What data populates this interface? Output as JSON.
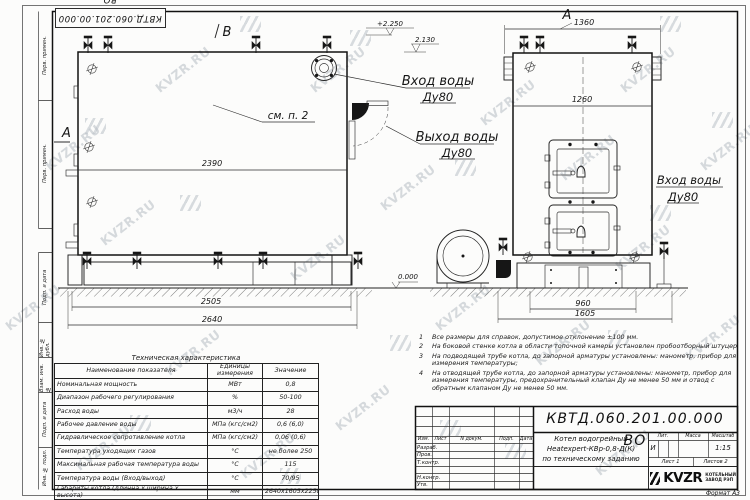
{
  "sheet": {
    "top_stamp": "КВТД.060.201.00.000 ВО",
    "watermark": "KVZR.RU"
  },
  "margin": {
    "labels": [
      "Перв. примен.",
      "Перв. примен.",
      "Подп. и дата",
      "Инв. № дубл.",
      "Взам. инв. №",
      "Подп. и дата",
      "Инв. № подл."
    ]
  },
  "drawing": {
    "markers": {
      "b": "B",
      "a_side": "A",
      "a_view": "A"
    },
    "see_note": "см. п. 2",
    "elevations": {
      "top": "+2.250",
      "mid": "2.130",
      "zero": "0.000"
    },
    "dims": {
      "side_inner": "2390",
      "side_skid": "2505",
      "side_total": "2640",
      "front_top": "1360",
      "front_body": "1260",
      "front_base": "960",
      "front_total": "1605"
    },
    "labels": {
      "inlet_top": {
        "title": "Вход воды",
        "dn": "Ду80"
      },
      "outlet": {
        "title": "Выход воды",
        "dn": "Ду80"
      },
      "inlet_side": {
        "title": "Вход воды",
        "dn": "Ду80"
      }
    }
  },
  "spec_table": {
    "title": "Техническая характеристика",
    "headers": [
      "Наименование показателя",
      "Единицы измерения",
      "Значение"
    ],
    "rows": [
      {
        "name": "Номинальная мощность",
        "unit": "МВт",
        "value": "0,8"
      },
      {
        "name": "Диапазон рабочего регулирования",
        "unit": "%",
        "value": "50-100"
      },
      {
        "name": "Расход воды",
        "unit": "м3/ч",
        "value": "28"
      },
      {
        "name": "Рабочее давление воды",
        "unit": "МПа (кгс/см2)",
        "value": "0,6 (6,0)"
      },
      {
        "name": "Гидравлическое сопротивление котла",
        "unit": "МПа (кгс/см2)",
        "value": "0,06 (0,6)"
      },
      {
        "name": "Температура уходящих газов",
        "unit": "°С",
        "value": "не более 250"
      },
      {
        "name": "Максимальная рабочая температура воды",
        "unit": "°С",
        "value": "115"
      },
      {
        "name": "Температура воды (Вход/выход)",
        "unit": "°С",
        "value": "70/95"
      },
      {
        "name": "Габариты котла (длинна х ширина х высота)",
        "unit": "мм",
        "value": "2640х1605х2250"
      }
    ]
  },
  "notes": {
    "items": [
      {
        "num": "1",
        "text": "Все размеры для справок, допустимое отклонение ±100 мм."
      },
      {
        "num": "2",
        "text": "На боковой стенке котла в области топочной камеры установлен пробоотборный штуцер"
      },
      {
        "num": "3",
        "text": "На подводящей трубе котла, до запорной арматуры установлены: манометр, прибор для измерения температуры;"
      },
      {
        "num": "4",
        "text": "На отводящей трубе котла, до запорной арматуры установлены: манометр, прибор для измерения температуры, предохранительный клапан Ду не менее 50 мм и отвод с обратным клапаном Ду не менее 50 мм."
      }
    ]
  },
  "title_block": {
    "doc_number": "КВТД.060.201.00.000 ВО",
    "columns": [
      "Изм.",
      "Лист",
      "N докум.",
      "Подп.",
      "Дата"
    ],
    "rows": [
      "Разраб.",
      "Пров.",
      "Т.контр.",
      "Н.контр.",
      "Утв."
    ],
    "name_line1": "Котел водогрейный",
    "name_line2": "Heatexpert-КВр-0,8-Д(К)",
    "name_line3": "по техническому заданию",
    "lit_label": "Лит.",
    "lit_value": "И",
    "mass_label": "Масса",
    "scale_label": "Масштаб",
    "scale_value": "1:15",
    "sheet_label": "Лист",
    "sheet_value": "1",
    "sheets_label": "Листов",
    "sheets_value": "2",
    "company": "KVZR",
    "company_line1": "КОТЕЛЬНЫЙ",
    "company_line2": "ЗАВОД РЭП",
    "format": "Формат А3"
  }
}
